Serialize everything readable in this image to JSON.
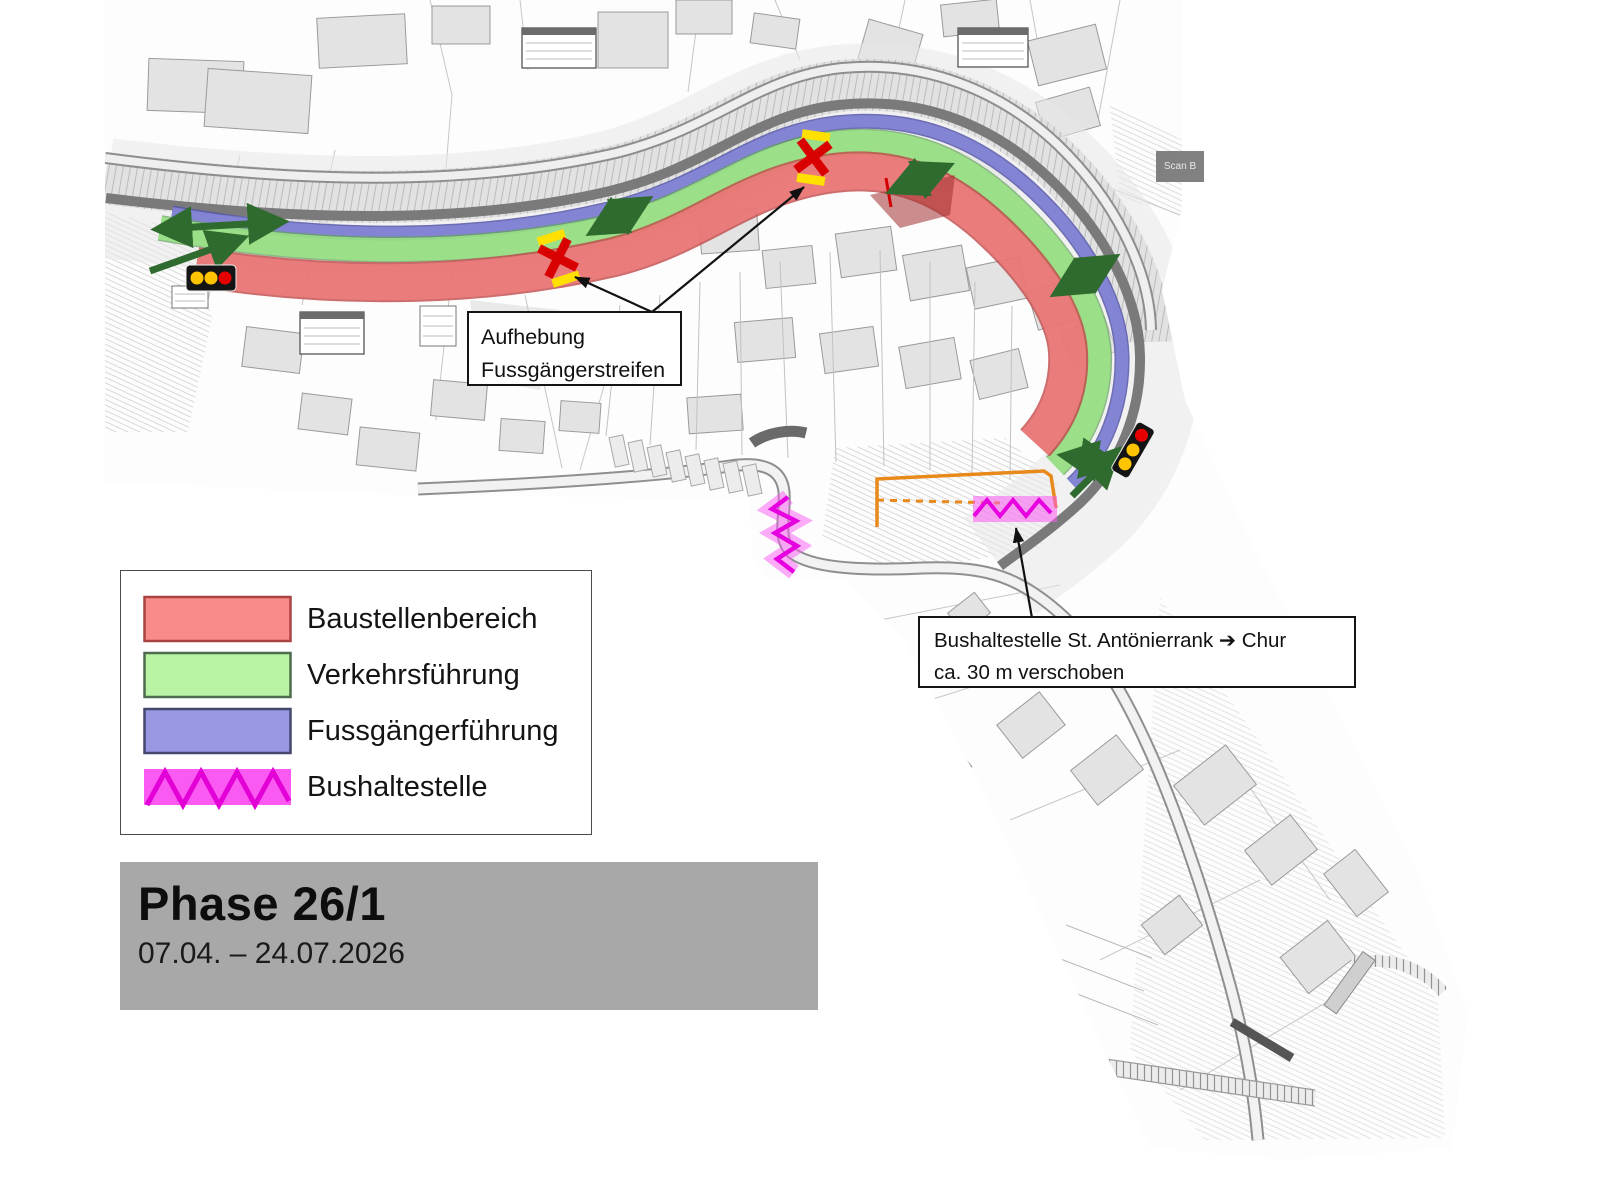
{
  "legend": {
    "items": [
      {
        "label": "Baustellenbereich",
        "fill": "#f98b8b",
        "stroke": "#a94442"
      },
      {
        "label": "Verkehrsführung",
        "fill": "#b9f3a4",
        "stroke": "#4d6b4d"
      },
      {
        "label": "Fussgängerführung",
        "fill": "#9898e2",
        "stroke": "#45476e"
      },
      {
        "label": "Bushaltestelle",
        "fill": "#fa5af2",
        "stroke": "#e300d6"
      }
    ]
  },
  "phase": {
    "title": "Phase 26/1",
    "date_range": "07.04. – 24.07.2026",
    "background": "#a8a8a8"
  },
  "callouts": {
    "crossing_removal": {
      "line1": "Aufhebung",
      "line2": "Fussgängerstreifen"
    },
    "bus_stop_shift": {
      "line1": "Bushaltestelle St. Antönierrank ➔ Chur",
      "line2": "ca. 30 m verschoben"
    }
  },
  "map": {
    "scan_label": "Scan B",
    "colors": {
      "construction_zone": "#f28080",
      "traffic_routing": "#9fe88a",
      "pedestrian_routing": "#8686d8",
      "bus_stop": "#e600e0",
      "direction_arrow": "#2f6b2f",
      "signal_red": "#e60000",
      "signal_yellow": "#ffc400",
      "crossing_x": "#d80000",
      "crossing_bar": "#ffe000",
      "shift_marker": "#e8891c"
    },
    "icons": [
      {
        "name": "traffic-light-icon",
        "position": "west-end",
        "lamps": "yellow-yellow-red"
      },
      {
        "name": "traffic-light-icon",
        "position": "east-bend",
        "lamps": "red-yellow-yellow"
      },
      {
        "name": "crossing-removed-icon",
        "position": "west-crossing"
      },
      {
        "name": "crossing-removed-icon",
        "position": "crest-crossing"
      },
      {
        "name": "bus-stop-zigzag",
        "position": "hairpin-west"
      },
      {
        "name": "bus-stop-zigzag",
        "position": "junction-south"
      }
    ]
  }
}
